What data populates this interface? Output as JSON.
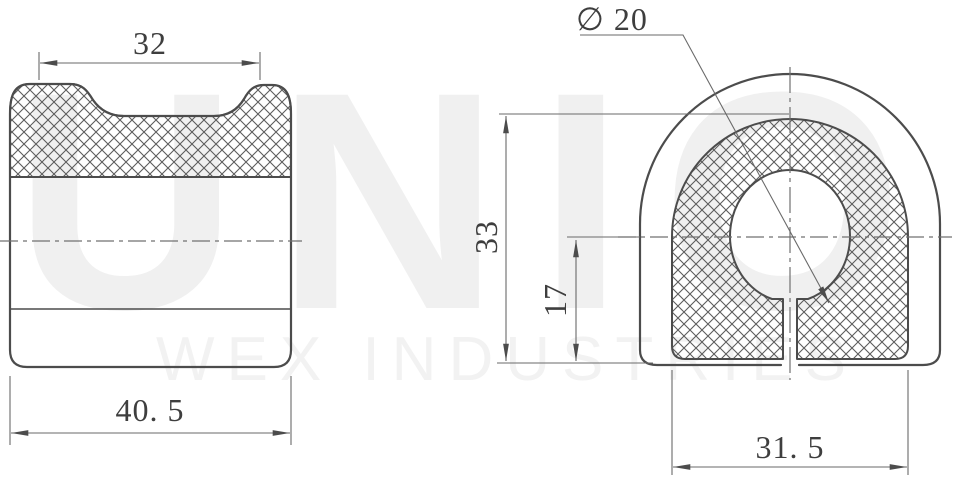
{
  "watermark": {
    "line1": "UNIO",
    "line2": "WEX INDUSTRIES"
  },
  "front_view": {
    "top_width": "32",
    "overall_width": "40. 5"
  },
  "side_view": {
    "hole_diameter": "∅ 20",
    "overall_height": "33",
    "center_height": "17",
    "bottom_width": "31. 5"
  },
  "colors": {
    "line": "#4c4c4c",
    "dimension": "#6a6a6a",
    "text": "#3e3e3e",
    "watermark": "#f0f0f0",
    "background": "#ffffff"
  }
}
